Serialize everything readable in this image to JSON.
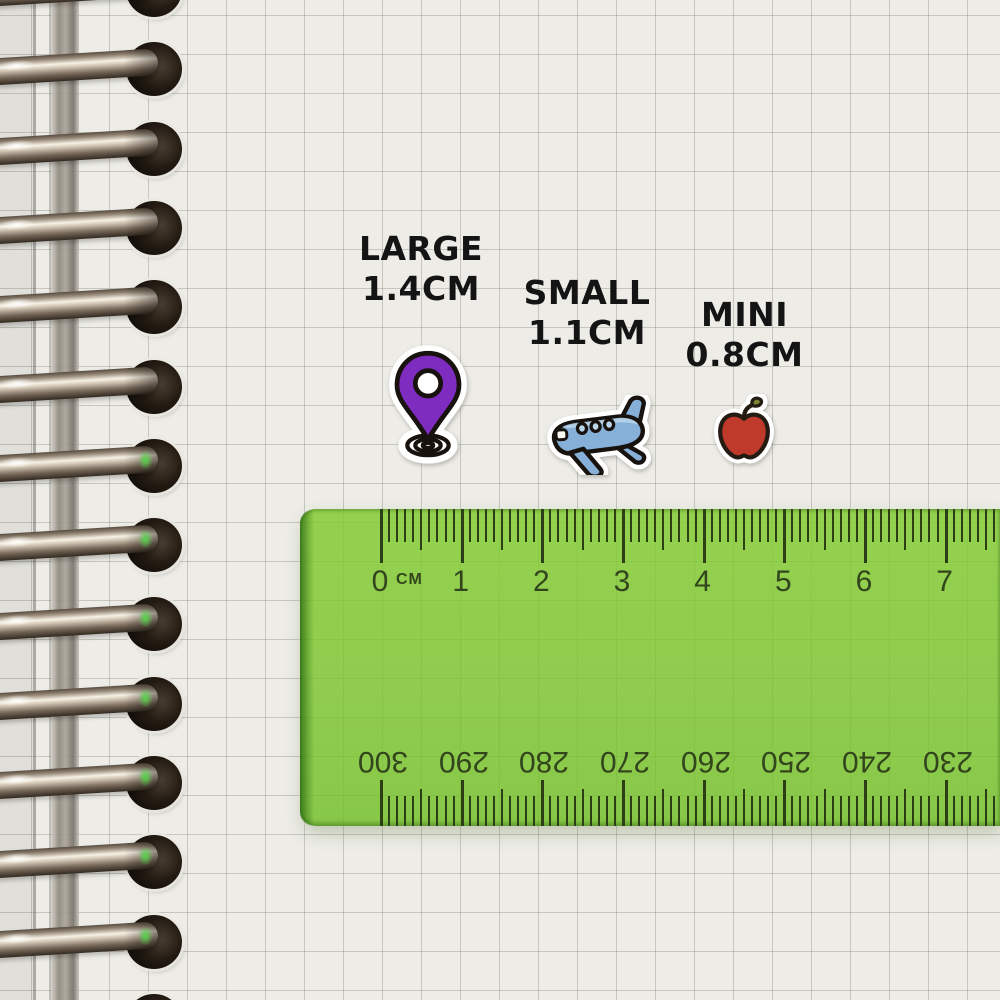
{
  "sticker_labels": [
    {
      "name": "LARGE",
      "size": "1.4CM"
    },
    {
      "name": "SMALL",
      "size": "1.1CM"
    },
    {
      "name": "MINI",
      "size": "0.8CM"
    }
  ],
  "stickers": [
    {
      "icon": "location-pin-icon"
    },
    {
      "icon": "airplane-icon"
    },
    {
      "icon": "apple-icon"
    }
  ],
  "ruler": {
    "unit_label": "CM",
    "top_numbers": [
      "0",
      "1",
      "2",
      "3",
      "4",
      "5",
      "6",
      "7"
    ],
    "bottom_numbers": [
      "300",
      "290",
      "280",
      "270",
      "260",
      "250",
      "240",
      "230"
    ]
  },
  "notebook": {
    "ring_count": 14
  },
  "colors": {
    "tick-color": "#2c3e14",
    "ruler-green": "#86bb49",
    "sticker-purple": "#7e2bbf",
    "plane-blue": "#86b0d8",
    "plane-light": "#bad6ea",
    "apple-red": "#bf3a2b",
    "leaf-green": "#7a8538",
    "label-black": "#141414"
  }
}
